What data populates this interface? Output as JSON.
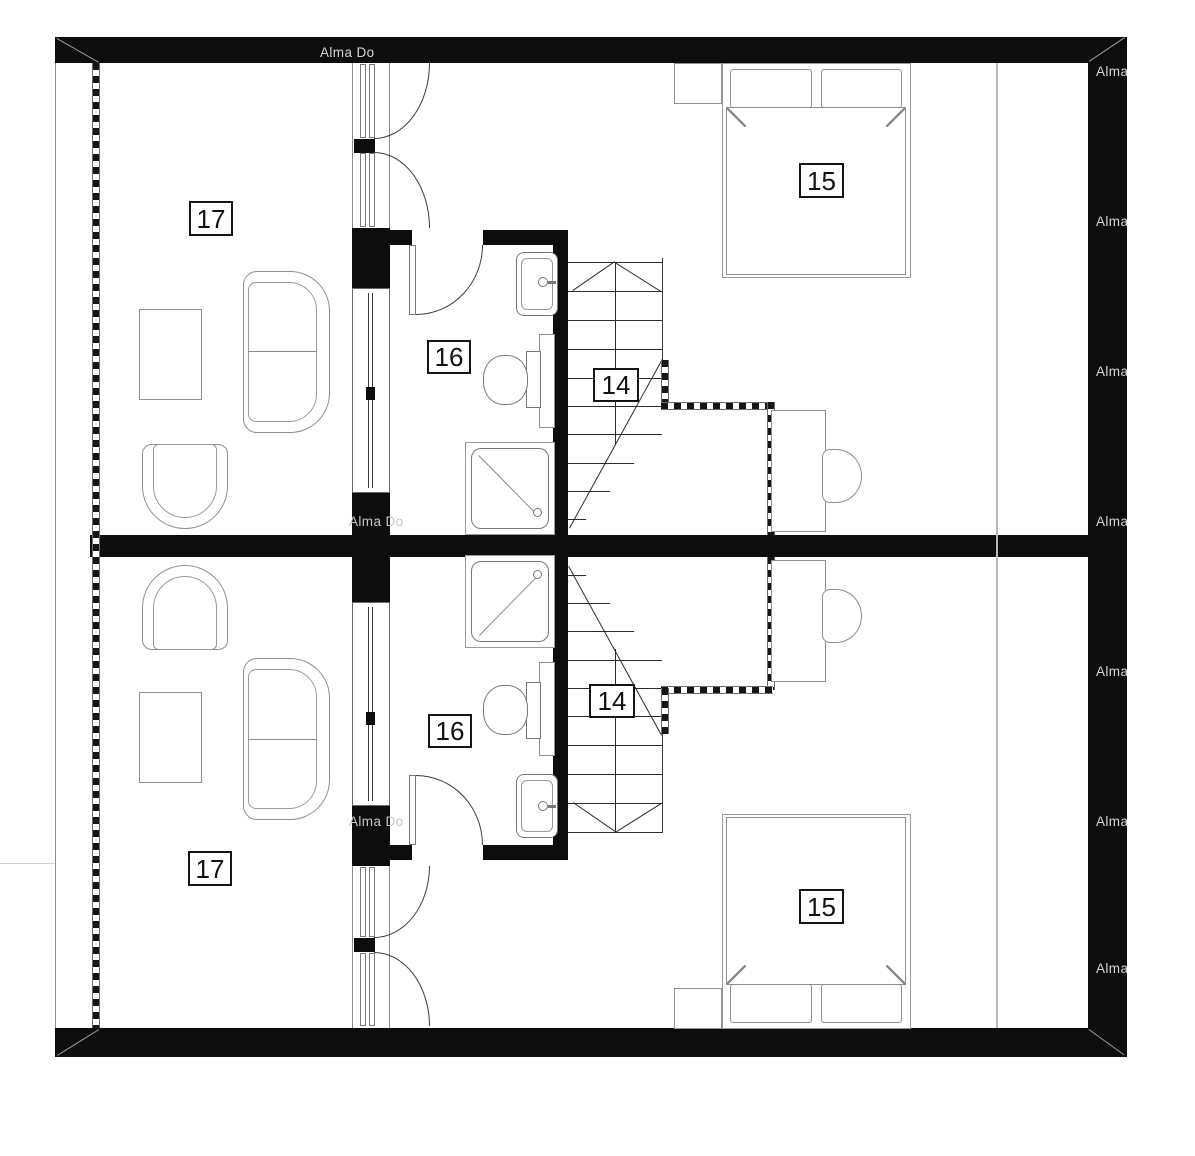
{
  "plan": {
    "type": "floor-plan",
    "background": "#ffffff",
    "wall_color": "#0d0d0d",
    "units": [
      "upper",
      "lower"
    ],
    "watermark": {
      "brand": "Alma",
      "fragment": "Alma Do"
    },
    "rooms": [
      {
        "label": "17",
        "name": "living-room",
        "unit": "upper"
      },
      {
        "label": "16",
        "name": "bathroom",
        "unit": "upper"
      },
      {
        "label": "14",
        "name": "staircase",
        "unit": "upper"
      },
      {
        "label": "15",
        "name": "bedroom",
        "unit": "upper"
      },
      {
        "label": "14",
        "name": "staircase",
        "unit": "lower"
      },
      {
        "label": "16",
        "name": "bathroom",
        "unit": "lower"
      },
      {
        "label": "17",
        "name": "living-room",
        "unit": "lower"
      },
      {
        "label": "15",
        "name": "bedroom",
        "unit": "lower"
      }
    ],
    "symbols": {
      "sofa": "two-seat sofa",
      "armchair": "armchair",
      "coffee_table": "coffee table",
      "bed": "double bed with two pillows",
      "nightstand": "nightstand",
      "desk": "desk with chair",
      "sink": "washbasin with faucet",
      "toilet": "toilet with cistern",
      "shower": "shower tray with drain",
      "stairs": "staircase with direction arrow and break line",
      "railing": "stair-void railing (dashed)",
      "window": "window glazing in partition",
      "door": "door leaf with swing arc"
    }
  }
}
